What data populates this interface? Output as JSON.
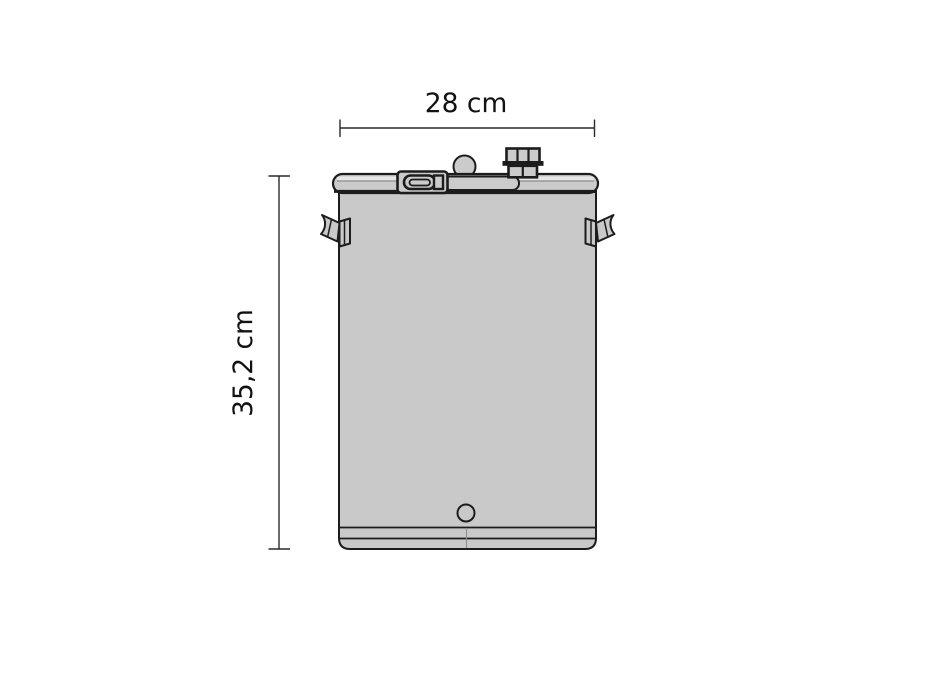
{
  "diagram": {
    "subject": "steel-drum-with-clamp-lid-front-view",
    "width_dimension": {
      "label": "28 cm"
    },
    "height_dimension": {
      "label": "35,2 cm"
    },
    "colors": {
      "background": "#ffffff",
      "body_fill": "#c9c9c9",
      "lid_fill": "#cbcbcb",
      "outline": "#1c1c1c",
      "dim_line": "#2a2a2a",
      "seam": "#8d8d8d",
      "text": "#121212"
    }
  }
}
